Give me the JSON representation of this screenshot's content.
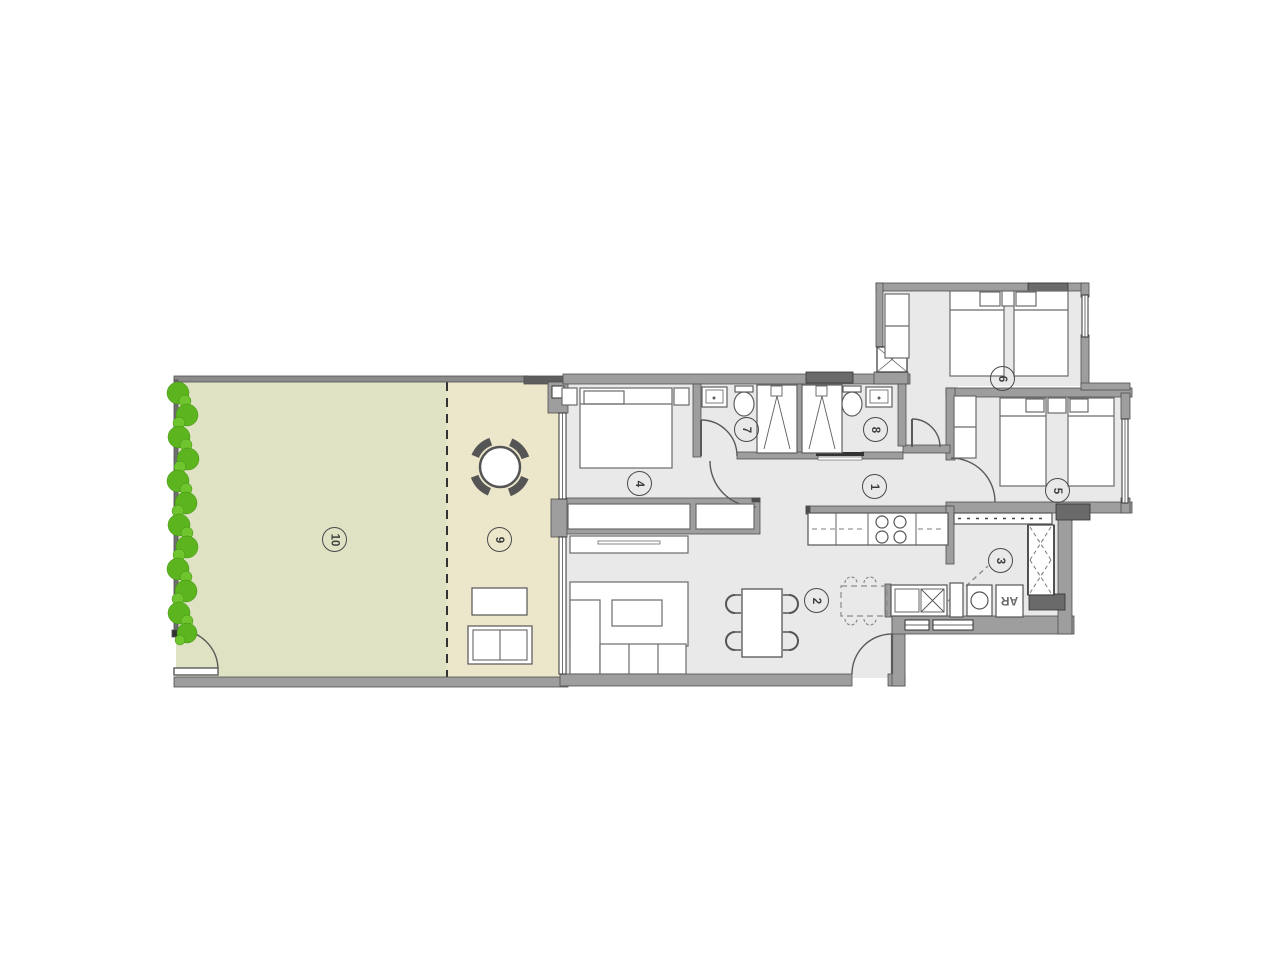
{
  "plan": {
    "type": "apartment floor plan",
    "labels": {
      "ar": "AR",
      "rooms": {
        "hallway": "1",
        "living_dining": "2",
        "entry_laundry": "3",
        "bedroom_main": "4",
        "bedroom_2": "5",
        "bedroom_3": "6",
        "bathroom_1": "7",
        "bathroom_2": "8",
        "terrace": "9",
        "garden": "10"
      }
    },
    "palette": {
      "background": "#ffffff",
      "garden": "#dfe3c4",
      "terrace": "#ece7cb",
      "hedge_green": "#5cb51f",
      "hedge_green_light": "#6fc52d",
      "interior_floor": "#e9e9e9",
      "wall_gray": "#9e9e9e",
      "wall_dark": "#5e5e5e",
      "shaft_gray": "#6a6a6a",
      "line_dark": "#4a4a4a",
      "furniture_stroke": "#6b6b6b"
    }
  }
}
